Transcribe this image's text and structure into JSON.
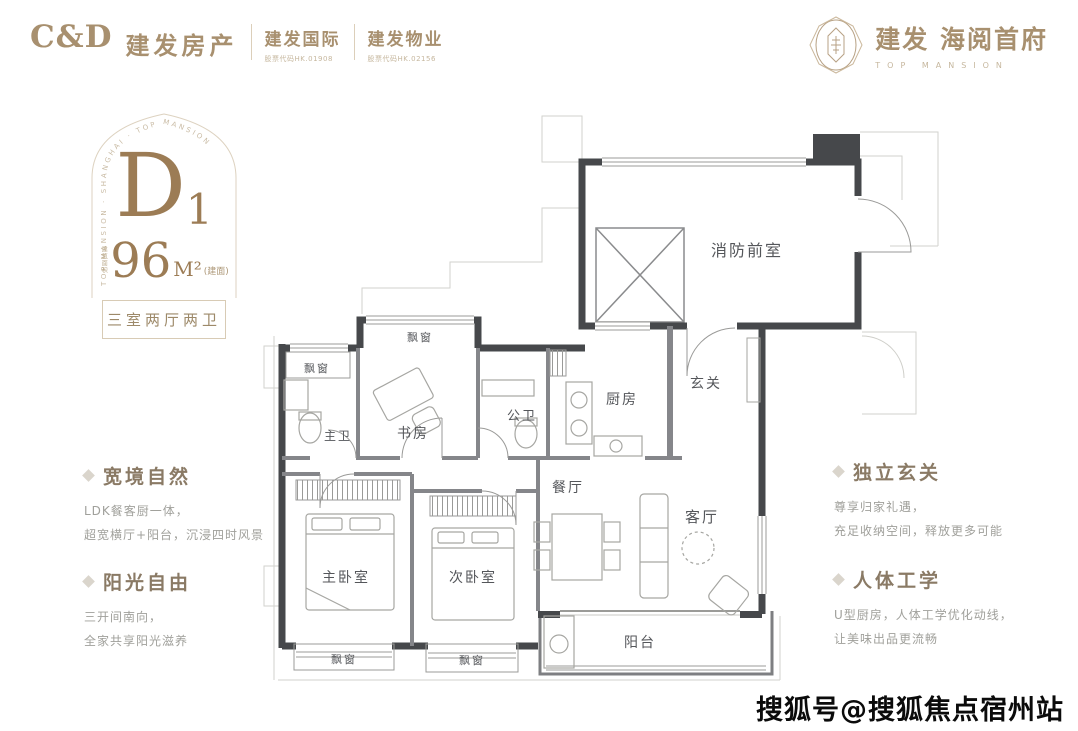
{
  "header": {
    "logo": "C&D",
    "brand": "建发房产",
    "partners": [
      {
        "name": "建发国际",
        "code": "股票代码HK.01908"
      },
      {
        "name": "建发物业",
        "code": "股票代码HK.02156"
      }
    ],
    "project": {
      "cn": "建发 海阅首府",
      "en": "TOP MANSION"
    }
  },
  "unit": {
    "arch_text": "TOP MANSION · SHANGHAI · TOP MANSION",
    "code": "D",
    "code_sub": "1",
    "area_label": "建筑面积",
    "area_value": "96",
    "area_unit": "M²",
    "area_note": "(建面)",
    "layout_label": "三室两厅两卫"
  },
  "features_left": [
    {
      "title": "宽境自然",
      "line1": "LDK餐客厨一体，",
      "line2": "超宽横厅+阳台，沉浸四时风景"
    },
    {
      "title": "阳光自由",
      "line1": "三开间南向，",
      "line2": "全家共享阳光滋养"
    }
  ],
  "features_right": [
    {
      "title": "独立玄关",
      "line1": "尊享归家礼遇，",
      "line2": "充足收纳空间，释放更多可能"
    },
    {
      "title": "人体工学",
      "line1": "U型厨房，人体工学优化动线，",
      "line2": "让美味出品更流畅"
    }
  ],
  "floorplan": {
    "rooms": {
      "fire_lobby": "消防前室",
      "bay_top": "飘窗",
      "bay_left": "飘窗",
      "study": "书房",
      "master_bath": "主卫",
      "guest_bath": "公卫",
      "kitchen": "厨房",
      "foyer": "玄关",
      "dining": "餐厅",
      "living": "客厅",
      "master_bed": "主卧室",
      "second_bed": "次卧室",
      "balcony": "阳台",
      "bay_bottom_left": "飘窗",
      "bay_bottom_right": "飘窗"
    }
  },
  "watermark": "搜狐号@搜狐焦点宿州站",
  "colors": {
    "brand": "#a8906f",
    "accent_dark": "#9c7c55",
    "wall": "#46484b",
    "text_gray": "#9b9b97"
  }
}
